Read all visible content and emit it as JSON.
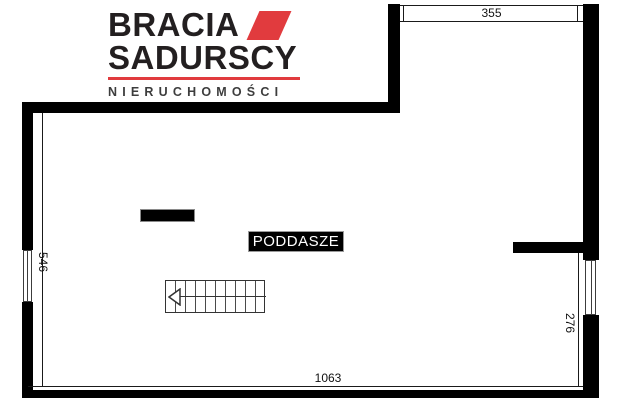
{
  "brand": {
    "name_line1": "BRACIA",
    "name_line2": "SADURSCY",
    "tagline": "NIERUCHOMOŚCI",
    "colors": {
      "red": "#e13b3e",
      "black": "#231f20"
    }
  },
  "floor_plan": {
    "room_label": "PODDASZE",
    "dimensions": {
      "top": "355",
      "left": "546",
      "right": "276",
      "bottom": "1063"
    }
  }
}
